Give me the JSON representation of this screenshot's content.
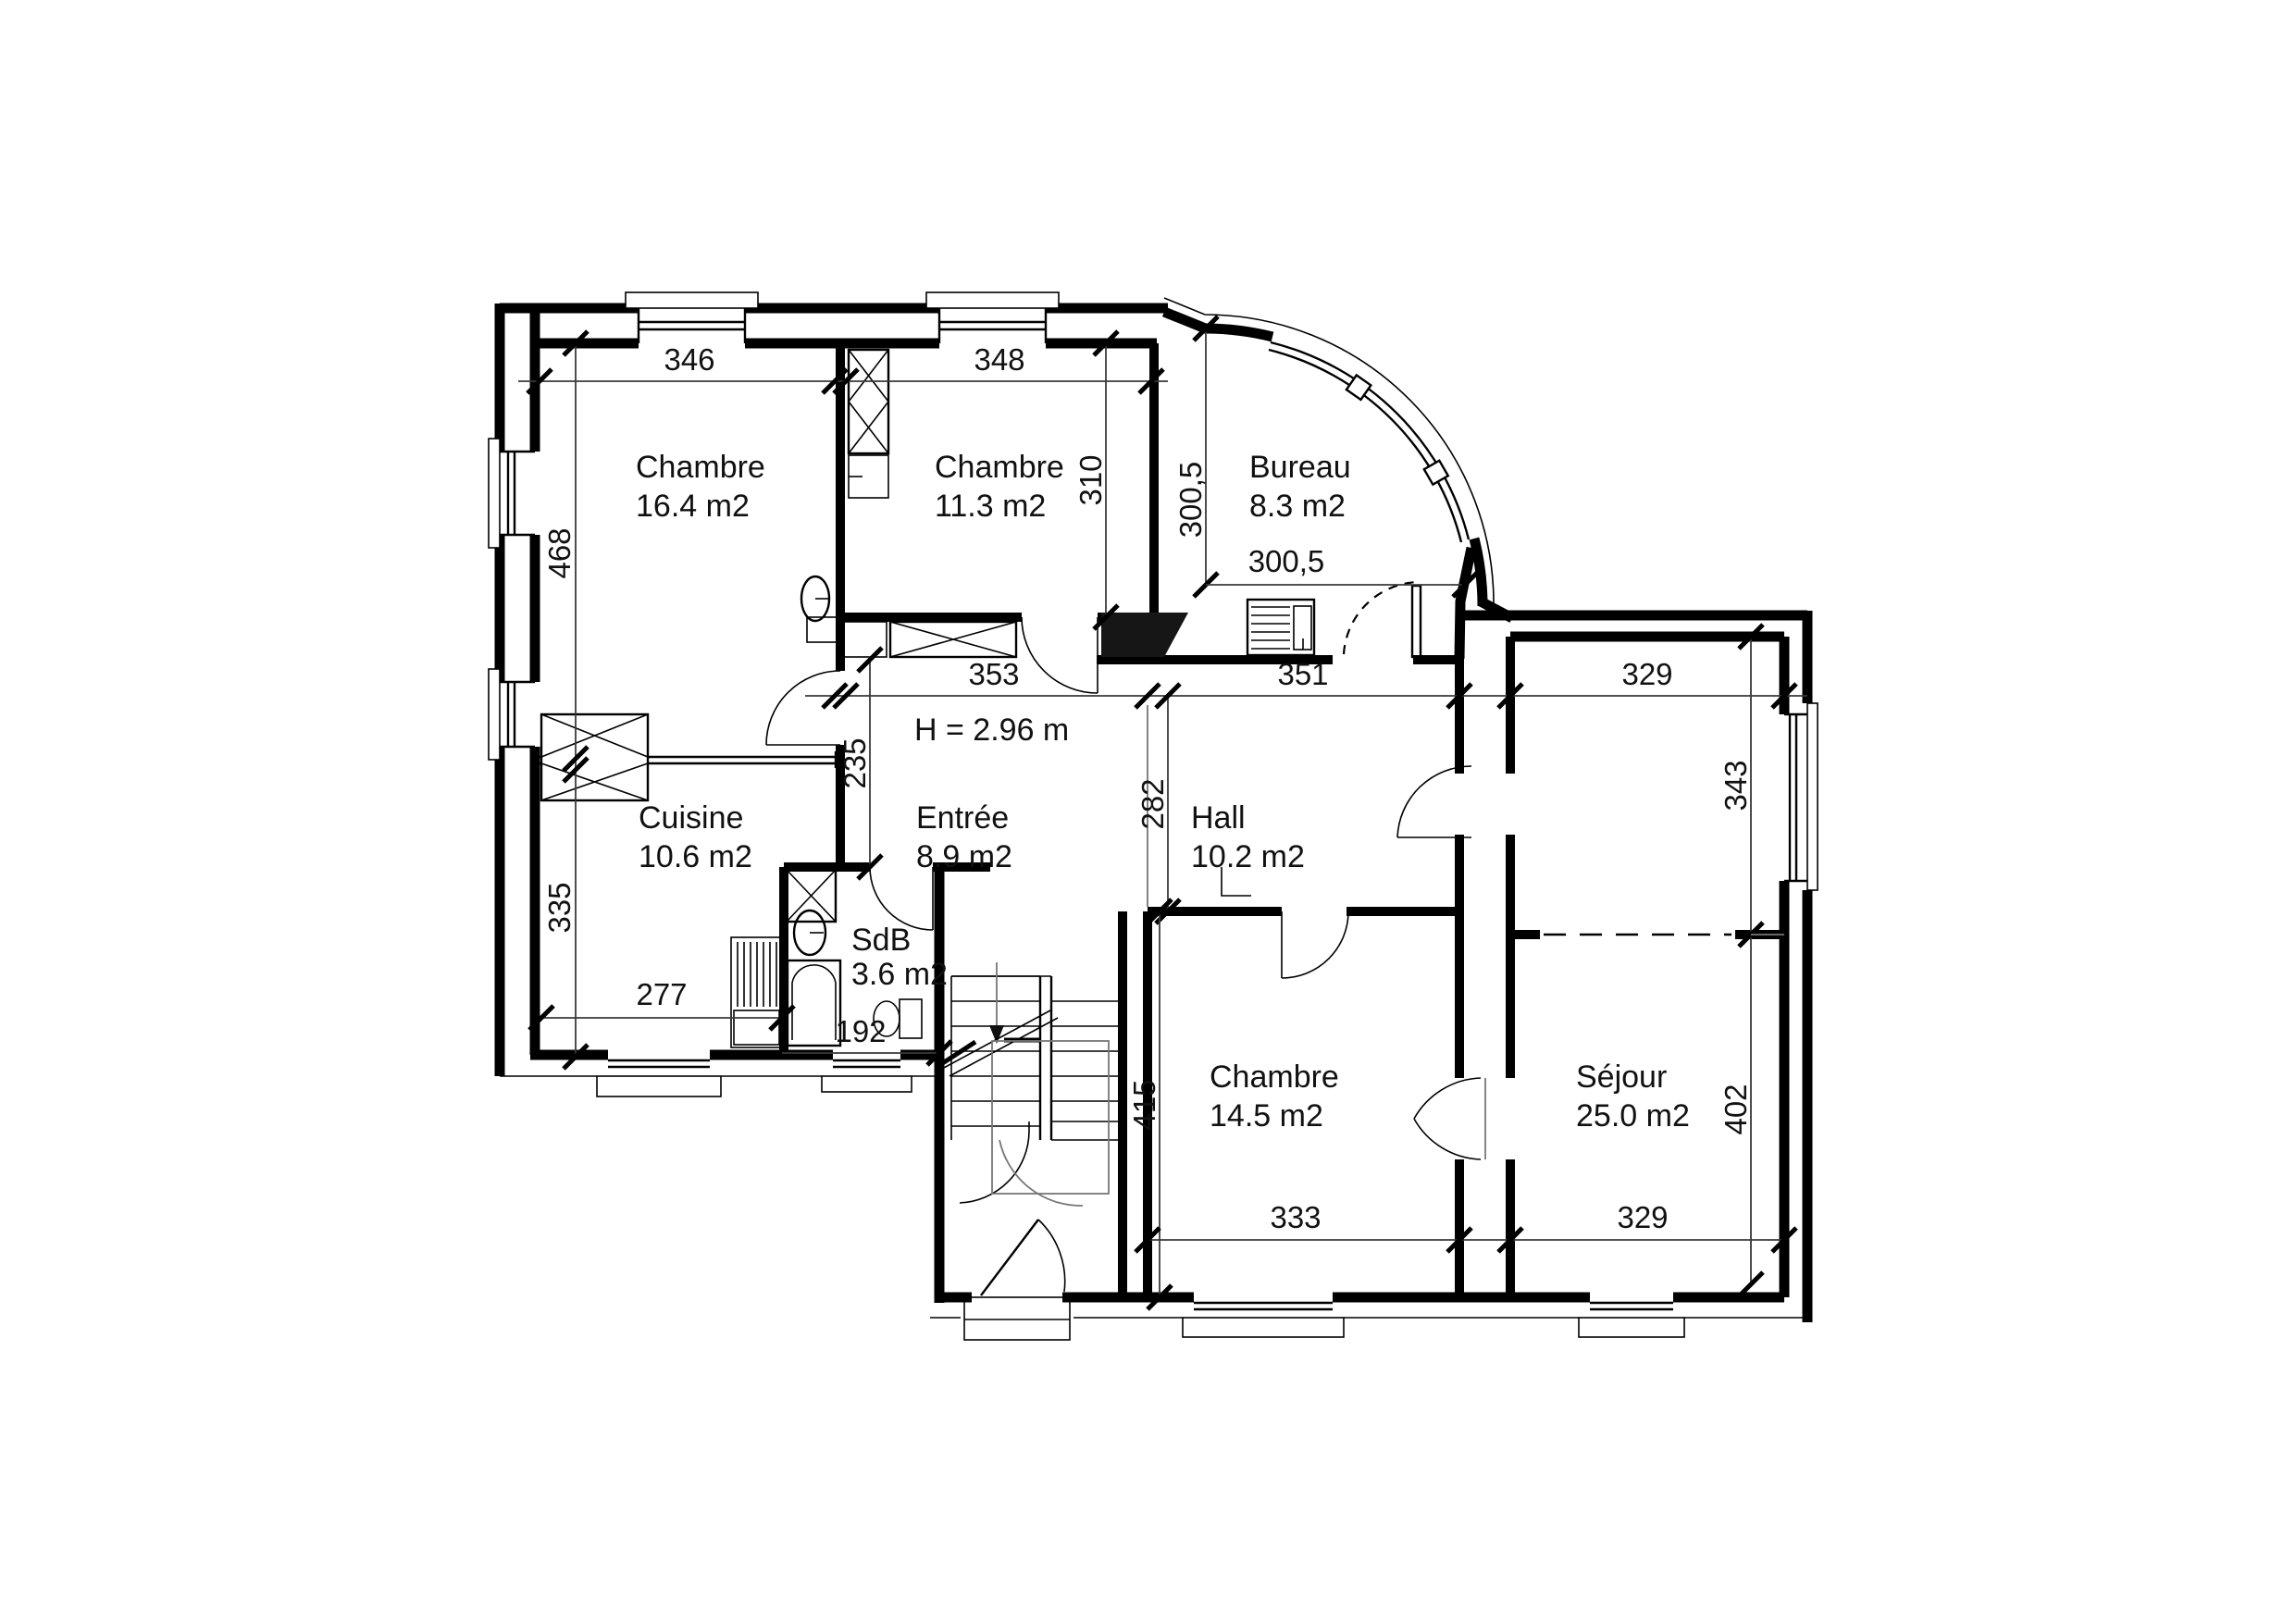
{
  "page": {
    "background": "#ffffff",
    "line_color": "#000000",
    "text_color": "#111111"
  },
  "plan": {
    "ceiling_note": "H = 2.96 m",
    "rooms": {
      "chambre1": {
        "name": "Chambre",
        "area": "16.4 m2"
      },
      "chambre2": {
        "name": "Chambre",
        "area": "11.3 m2"
      },
      "bureau": {
        "name": "Bureau",
        "area": "8.3 m2"
      },
      "cuisine": {
        "name": "Cuisine",
        "area": "10.6 m2"
      },
      "entree": {
        "name": "Entrée",
        "area": "8.9 m2"
      },
      "hall": {
        "name": "Hall",
        "area": "10.2 m2"
      },
      "sdb": {
        "name": "SdB",
        "area": "3.6 m2"
      },
      "chambre3": {
        "name": "Chambre",
        "area": "14.5 m2"
      },
      "sejour": {
        "name": "Séjour",
        "area": "25.0 m2"
      }
    },
    "dimensions_cm": {
      "chambre1_width": "346",
      "chambre2_width": "348",
      "chambre2_depth": "310",
      "bureau_depth": "300,5",
      "bureau_width": "300,5",
      "left_upper": "468",
      "left_lower": "335",
      "entree_width": "353",
      "hall_width": "351",
      "wing_top_width": "329",
      "entree_depth": "235",
      "hall_depth": "282",
      "cuisine_width": "277",
      "sdb_width": "192",
      "chambre3_depth": "415",
      "chambre3_width": "333",
      "sejour_upper_depth": "343",
      "sejour_lower_depth": "402",
      "sejour_width": "329"
    }
  }
}
